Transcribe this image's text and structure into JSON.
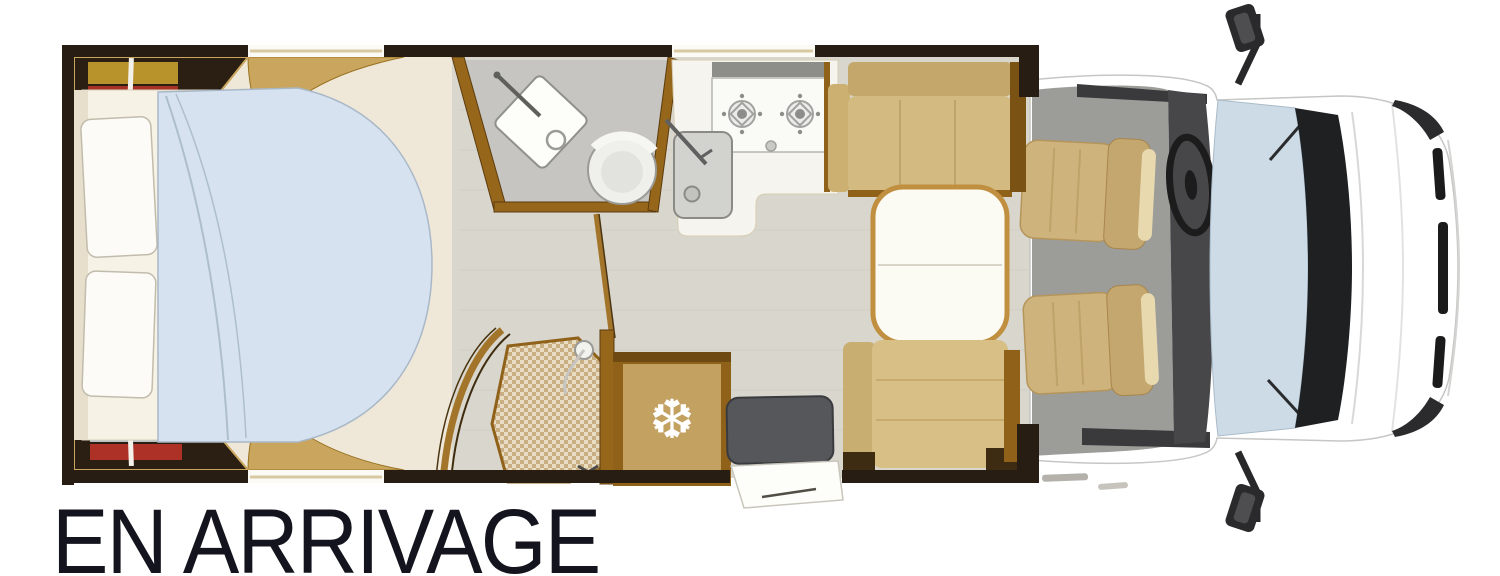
{
  "caption": {
    "text": "EN ARRIVAGE"
  },
  "icons": {
    "snowflake": "❆"
  },
  "colors": {
    "wall_dark": "#281d12",
    "wood": "#96661b",
    "wood_dark": "#6e4a12",
    "wood_light": "#c9a55e",
    "floor": "#d9d6cd",
    "bedroom_cream": "#efe8d8",
    "duvet_blue": "#d6e2ef",
    "pillow_white": "#fcfbf7",
    "bench_tan": "#d3ba80",
    "seat_tan": "#cfb37c",
    "table_white": "#fbfaf3",
    "table_rim": "#c09040",
    "counter_white": "#f5f4ee",
    "bathroom_gray": "#c6c5c1",
    "windshield_blue": "#cddbe7",
    "cab_floor_gray": "#9c9c99",
    "dash_dark": "#47474a",
    "dark_cabinet": "#55575b",
    "fridge_tan": "#c2a161",
    "book_yellow": "#b8922a",
    "book_red": "#a63226",
    "book_gray": "#b9bfc7",
    "caption_color": "#14141e"
  }
}
